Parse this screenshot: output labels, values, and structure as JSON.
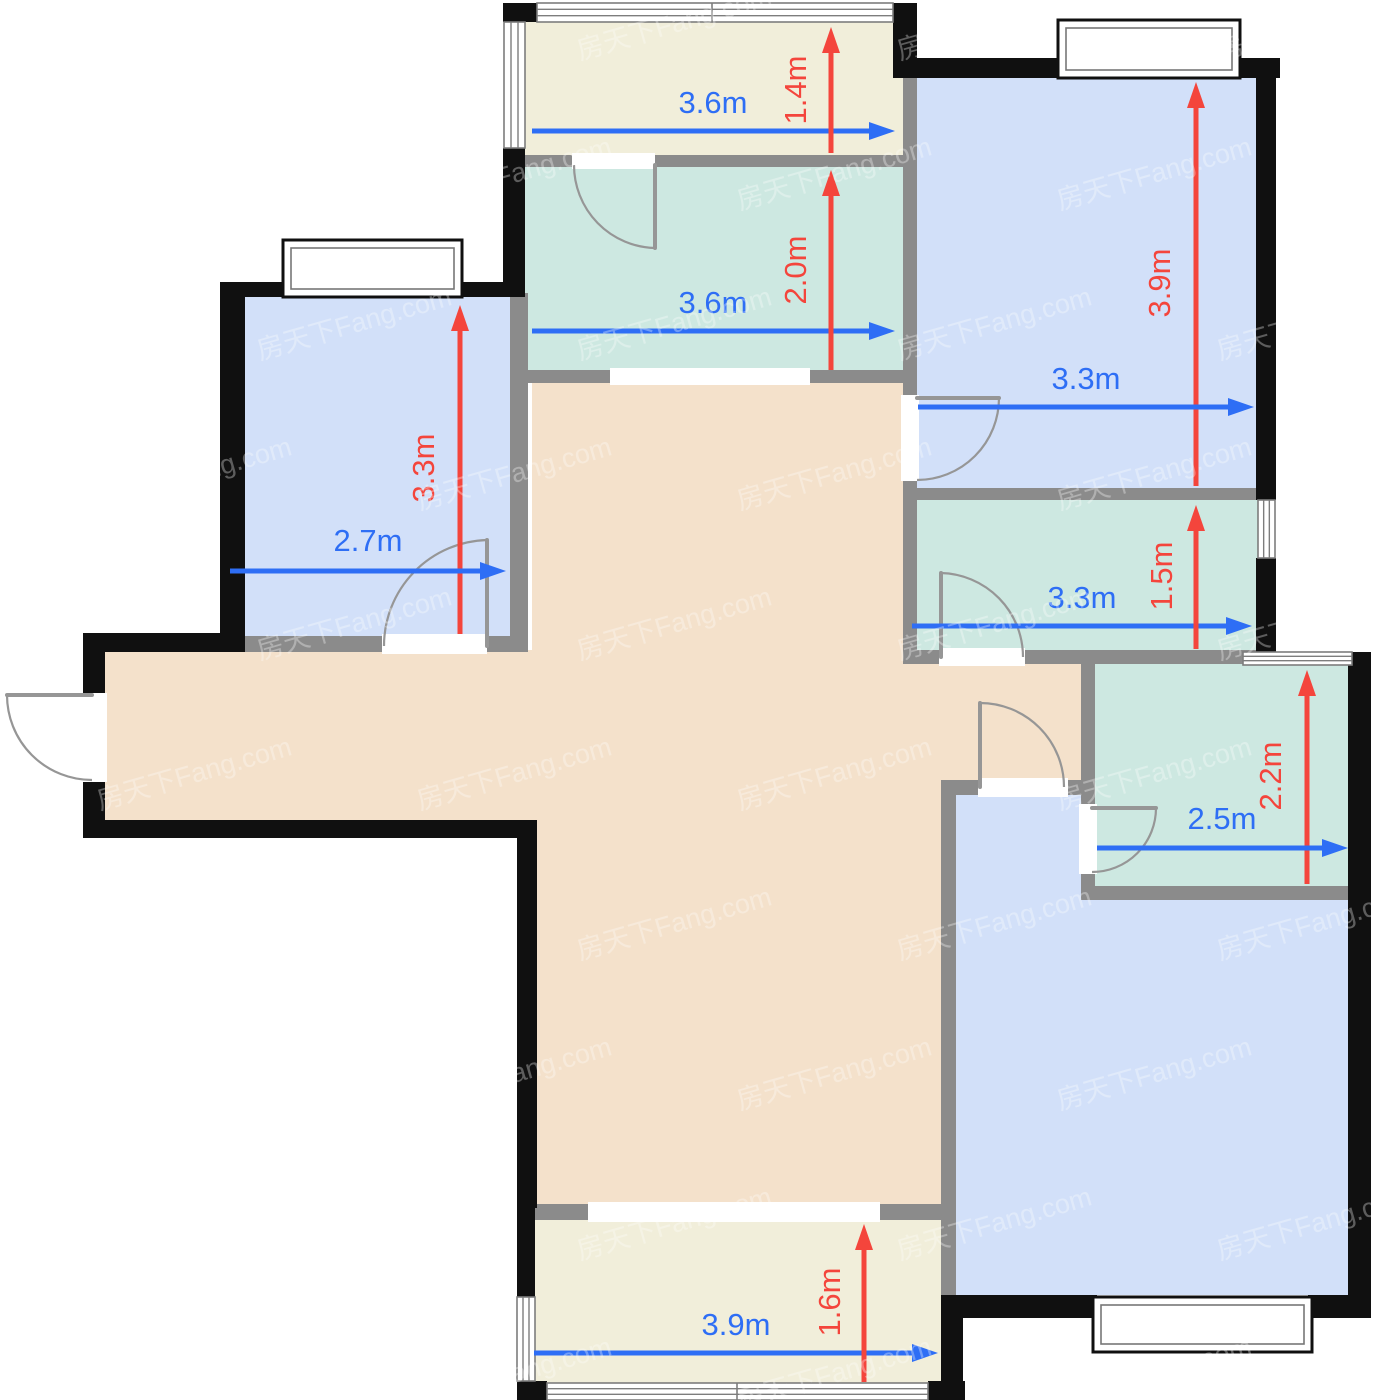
{
  "palette": {
    "wall_black": "#101010",
    "wall_gray": "#8b8b8b",
    "door_gray": "#969696",
    "window_stroke": "#7d7d7d",
    "blue_room": "#d2e0f9",
    "teal_room": "#cde8e1",
    "cream_room": "#f1eeda",
    "tan_hall": "#f4e1cb",
    "dim_blue": "#2e6ef5",
    "dim_red": "#f4453c",
    "bg": "#ffffff"
  },
  "watermark": {
    "text": "房天下Fang.com",
    "color": "#ffffff",
    "opacity": 0.32,
    "font_size": 27,
    "rotate": -16,
    "step_x": 320,
    "step_y": 150,
    "alt_offset": 160,
    "start_x": -60,
    "start_y": 60
  },
  "rooms": [
    {
      "id": "hallway-left-arm",
      "color": "tan_hall",
      "x": 105,
      "y": 650,
      "w": 427,
      "h": 172
    },
    {
      "id": "hallway-column",
      "color": "tan_hall",
      "x": 532,
      "y": 382,
      "w": 411,
      "h": 823
    },
    {
      "id": "hallway-right-arm",
      "color": "tan_hall",
      "x": 943,
      "y": 664,
      "w": 140,
      "h": 118
    },
    {
      "id": "balcony-top",
      "color": "cream_room",
      "x": 525,
      "y": 20,
      "w": 380,
      "h": 137
    },
    {
      "id": "balcony-bottom",
      "color": "cream_room",
      "x": 535,
      "y": 1208,
      "w": 406,
      "h": 175
    },
    {
      "id": "room-teal-top",
      "color": "teal_room",
      "x": 525,
      "y": 167,
      "w": 380,
      "h": 205
    },
    {
      "id": "bedroom-left",
      "color": "blue_room",
      "x": 245,
      "y": 297,
      "w": 265,
      "h": 341
    },
    {
      "id": "bedroom-top-right",
      "color": "blue_room",
      "x": 917,
      "y": 78,
      "w": 341,
      "h": 410
    },
    {
      "id": "room-teal-mid",
      "color": "teal_room",
      "x": 917,
      "y": 500,
      "w": 341,
      "h": 152
    },
    {
      "id": "bedroom-bottom-right",
      "color": "blue_room",
      "x": 956,
      "y": 795,
      "w": 392,
      "h": 500
    },
    {
      "id": "room-teal-right",
      "color": "teal_room",
      "x": 1095,
      "y": 664,
      "w": 253,
      "h": 224
    }
  ],
  "walls_gray": [
    [
      525,
      155,
      380,
      12
    ],
    [
      525,
      370,
      382,
      13
    ],
    [
      903,
      78,
      14,
      576
    ],
    [
      905,
      488,
      353,
      12
    ],
    [
      903,
      650,
      355,
      14
    ],
    [
      1083,
      650,
      160,
      14
    ],
    [
      1081,
      650,
      14,
      240
    ],
    [
      1081,
      886,
      271,
      14
    ],
    [
      941,
      788,
      15,
      510
    ],
    [
      941,
      780,
      144,
      15
    ],
    [
      510,
      293,
      18,
      359
    ],
    [
      245,
      636,
      265,
      16
    ],
    [
      535,
      1204,
      406,
      16
    ]
  ],
  "walls_black": [
    [
      503,
      3,
      35,
      19
    ],
    [
      893,
      3,
      24,
      75
    ],
    [
      893,
      58,
      165,
      20
    ],
    [
      1240,
      58,
      40,
      20
    ],
    [
      1256,
      58,
      20,
      442
    ],
    [
      1256,
      558,
      20,
      96
    ],
    [
      503,
      148,
      22,
      149
    ],
    [
      220,
      282,
      63,
      15
    ],
    [
      462,
      282,
      58,
      15
    ],
    [
      220,
      282,
      25,
      370
    ],
    [
      83,
      633,
      162,
      19
    ],
    [
      83,
      633,
      22,
      205
    ],
    [
      83,
      820,
      452,
      18
    ],
    [
      517,
      820,
      20,
      388
    ],
    [
      517,
      1206,
      18,
      93
    ],
    [
      517,
      1381,
      30,
      19
    ],
    [
      928,
      1381,
      37,
      19
    ],
    [
      941,
      1295,
      22,
      105
    ],
    [
      941,
      1295,
      156,
      23
    ],
    [
      1308,
      1295,
      44,
      23
    ],
    [
      1348,
      652,
      23,
      666
    ]
  ],
  "openings": [
    [
      610,
      368,
      200,
      17
    ],
    [
      588,
      1202,
      292,
      20
    ],
    [
      83,
      693,
      24,
      89
    ],
    [
      572,
      153,
      83,
      16
    ],
    [
      382,
      634,
      105,
      20
    ],
    [
      901,
      395,
      18,
      86
    ],
    [
      939,
      648,
      86,
      18
    ],
    [
      978,
      778,
      90,
      19
    ],
    [
      1079,
      804,
      18,
      70
    ]
  ],
  "windows_strip": [
    {
      "x": 537,
      "y": 3,
      "w": 356,
      "h": 19,
      "o": "h",
      "m": [
        712
      ]
    },
    {
      "x": 504,
      "y": 22,
      "w": 21,
      "h": 126,
      "o": "v",
      "m": []
    },
    {
      "x": 547,
      "y": 1383,
      "w": 381,
      "h": 17,
      "o": "h",
      "m": [
        737
      ]
    },
    {
      "x": 517,
      "y": 1297,
      "w": 18,
      "h": 84,
      "o": "v",
      "m": []
    },
    {
      "x": 1258,
      "y": 500,
      "w": 17,
      "h": 58,
      "o": "v",
      "m": []
    },
    {
      "x": 1243,
      "y": 652,
      "w": 109,
      "h": 13,
      "o": "h",
      "m": []
    }
  ],
  "bay_windows": [
    {
      "x": 283,
      "y": 240,
      "w": 179,
      "h": 57
    },
    {
      "x": 1058,
      "y": 20,
      "w": 182,
      "h": 58
    },
    {
      "x": 1093,
      "y": 1297,
      "w": 219,
      "h": 55
    }
  ],
  "doors": [
    {
      "id": "entry-door",
      "hx": 92,
      "hy": 695,
      "tx": 7,
      "ty": 695,
      "ex": 92,
      "ey": 780,
      "sweep": 0
    },
    {
      "id": "door-teal-top",
      "hx": 655,
      "hy": 165,
      "tx": 655,
      "ty": 248,
      "ex": 574,
      "ey": 165,
      "sweep": 1
    },
    {
      "id": "door-bedroom-left",
      "hx": 487,
      "hy": 646,
      "tx": 487,
      "ty": 540,
      "ex": 384,
      "ey": 646,
      "sweep": 0
    },
    {
      "id": "door-bedroom-top-right",
      "hx": 917,
      "hy": 398,
      "tx": 999,
      "ty": 398,
      "ex": 917,
      "ey": 480,
      "sweep": 1
    },
    {
      "id": "door-teal-mid",
      "hx": 941,
      "hy": 657,
      "tx": 941,
      "ty": 573,
      "ex": 1023,
      "ey": 657,
      "sweep": 1
    },
    {
      "id": "door-bedroom-bottom",
      "hx": 980,
      "hy": 787,
      "tx": 980,
      "ty": 703,
      "ex": 1064,
      "ey": 787,
      "sweep": 1
    },
    {
      "id": "door-teal-right",
      "hx": 1092,
      "hy": 808,
      "tx": 1156,
      "ty": 808,
      "ex": 1092,
      "ey": 872,
      "sweep": 1
    }
  ],
  "dimensions": [
    {
      "o": "h",
      "at": 131,
      "from": 532,
      "to": 895,
      "label": "3.6m",
      "lx": 713,
      "ly": 113
    },
    {
      "o": "v",
      "at": 831,
      "from": 153,
      "to": 27,
      "label": "1.4m",
      "lx": 806,
      "ly": 90
    },
    {
      "o": "h",
      "at": 331,
      "from": 532,
      "to": 895,
      "label": "3.6m",
      "lx": 713,
      "ly": 313
    },
    {
      "o": "v",
      "at": 831,
      "from": 370,
      "to": 170,
      "label": "2.0m",
      "lx": 806,
      "ly": 270
    },
    {
      "o": "v",
      "at": 1196,
      "from": 486,
      "to": 82,
      "label": "3.9m",
      "lx": 1170,
      "ly": 283
    },
    {
      "o": "h",
      "at": 407,
      "from": 918,
      "to": 1254,
      "label": "3.3m",
      "lx": 1086,
      "ly": 389
    },
    {
      "o": "v",
      "at": 460,
      "from": 634,
      "to": 305,
      "label": "3.3m",
      "lx": 434,
      "ly": 468
    },
    {
      "o": "h",
      "at": 571,
      "from": 230,
      "to": 506,
      "label": "2.7m",
      "lx": 368,
      "ly": 551
    },
    {
      "o": "h",
      "at": 626,
      "from": 912,
      "to": 1252,
      "label": "3.3m",
      "lx": 1082,
      "ly": 608
    },
    {
      "o": "v",
      "at": 1196,
      "from": 649,
      "to": 505,
      "label": "1.5m",
      "lx": 1172,
      "ly": 576
    },
    {
      "o": "v",
      "at": 1307,
      "from": 884,
      "to": 670,
      "label": "2.2m",
      "lx": 1281,
      "ly": 776
    },
    {
      "o": "h",
      "at": 848,
      "from": 1097,
      "to": 1348,
      "label": "2.5m",
      "lx": 1222,
      "ly": 829
    },
    {
      "o": "h",
      "at": 1353,
      "from": 534,
      "to": 938,
      "label": "3.9m",
      "lx": 736,
      "ly": 1335
    },
    {
      "o": "v",
      "at": 864,
      "from": 1382,
      "to": 1224,
      "label": "1.6m",
      "lx": 840,
      "ly": 1302
    }
  ],
  "dim_style": {
    "line_width": 5,
    "head_len": 26,
    "head_half_w": 9,
    "font_size": 31
  }
}
